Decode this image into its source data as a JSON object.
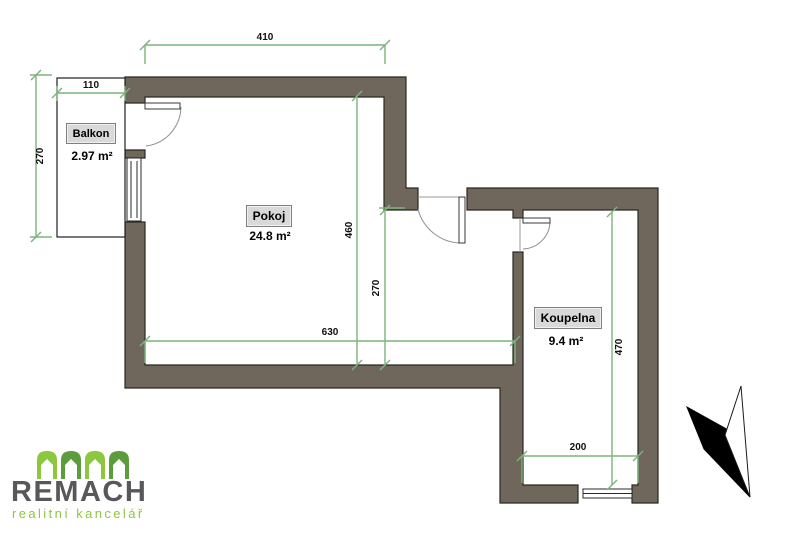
{
  "plan": {
    "rooms": {
      "pokoj": {
        "label": "Pokoj",
        "area": "24.8 m²"
      },
      "balkon": {
        "label": "Balkon",
        "area": "2.97 m²"
      },
      "koupelna": {
        "label": "Koupelna",
        "area": "9.4 m²"
      }
    },
    "dimensions": {
      "pokoj_top_width": "410",
      "balkon_width": "110",
      "balkon_depth": "270",
      "pokoj_left_height": "460",
      "pokoj_right_height": "270",
      "pokoj_bottom_width": "630",
      "koupelna_width": "200",
      "koupelna_height": "470"
    },
    "colors": {
      "wall_fill": "#6f675c",
      "wall_outline": "#2b2820",
      "dimension_green": "#7cb47c",
      "room_label_bg": "#d9d9d9"
    }
  },
  "branding": {
    "company": "REMACH",
    "tagline": "realitní kancelář",
    "logo_green_light": "#8dc63f",
    "logo_green_dark": "#5d9c3c",
    "logo_gray": "#58585a"
  }
}
